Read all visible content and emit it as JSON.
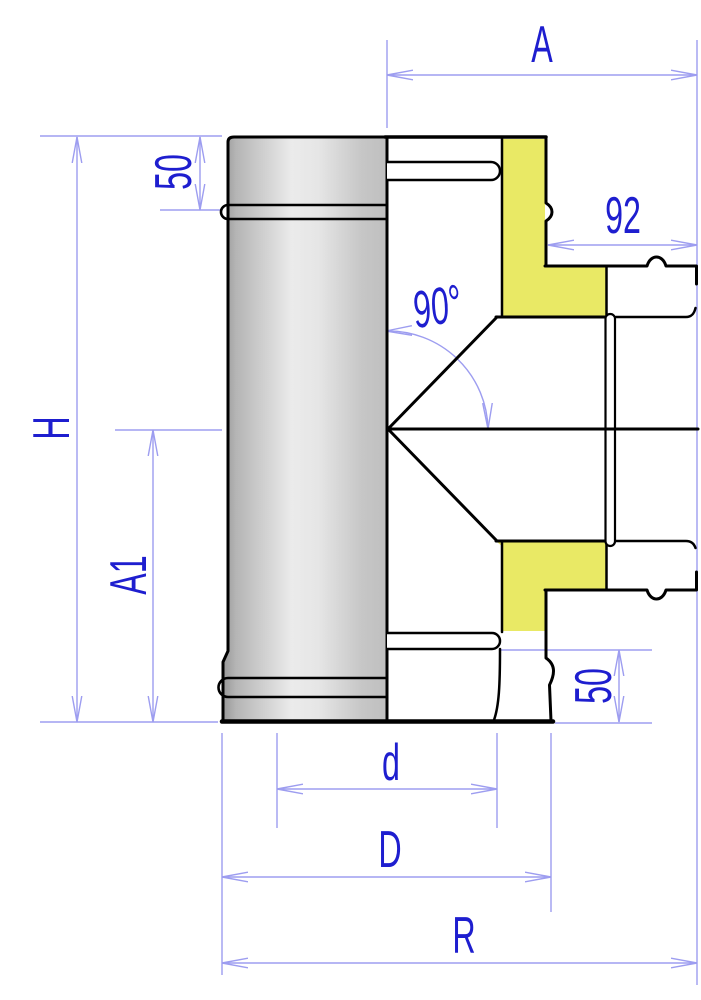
{
  "drawing": {
    "dimension_labels": {
      "A": "A",
      "top_offset": "50",
      "branch_outlet": "92",
      "angle": "90°",
      "H": "H",
      "A1": "A1",
      "bottom_offset": "50",
      "d": "d",
      "D": "D",
      "R": "R"
    }
  },
  "colors": {
    "background": "#ffffff",
    "outline": "#000000",
    "dim": "#9d9df0",
    "label": "#1e1ecf",
    "insulation": "#e9e965",
    "metal_dark": "#989898",
    "metal_mid": "#c6c6c6",
    "metal_light": "#ebebeb"
  }
}
